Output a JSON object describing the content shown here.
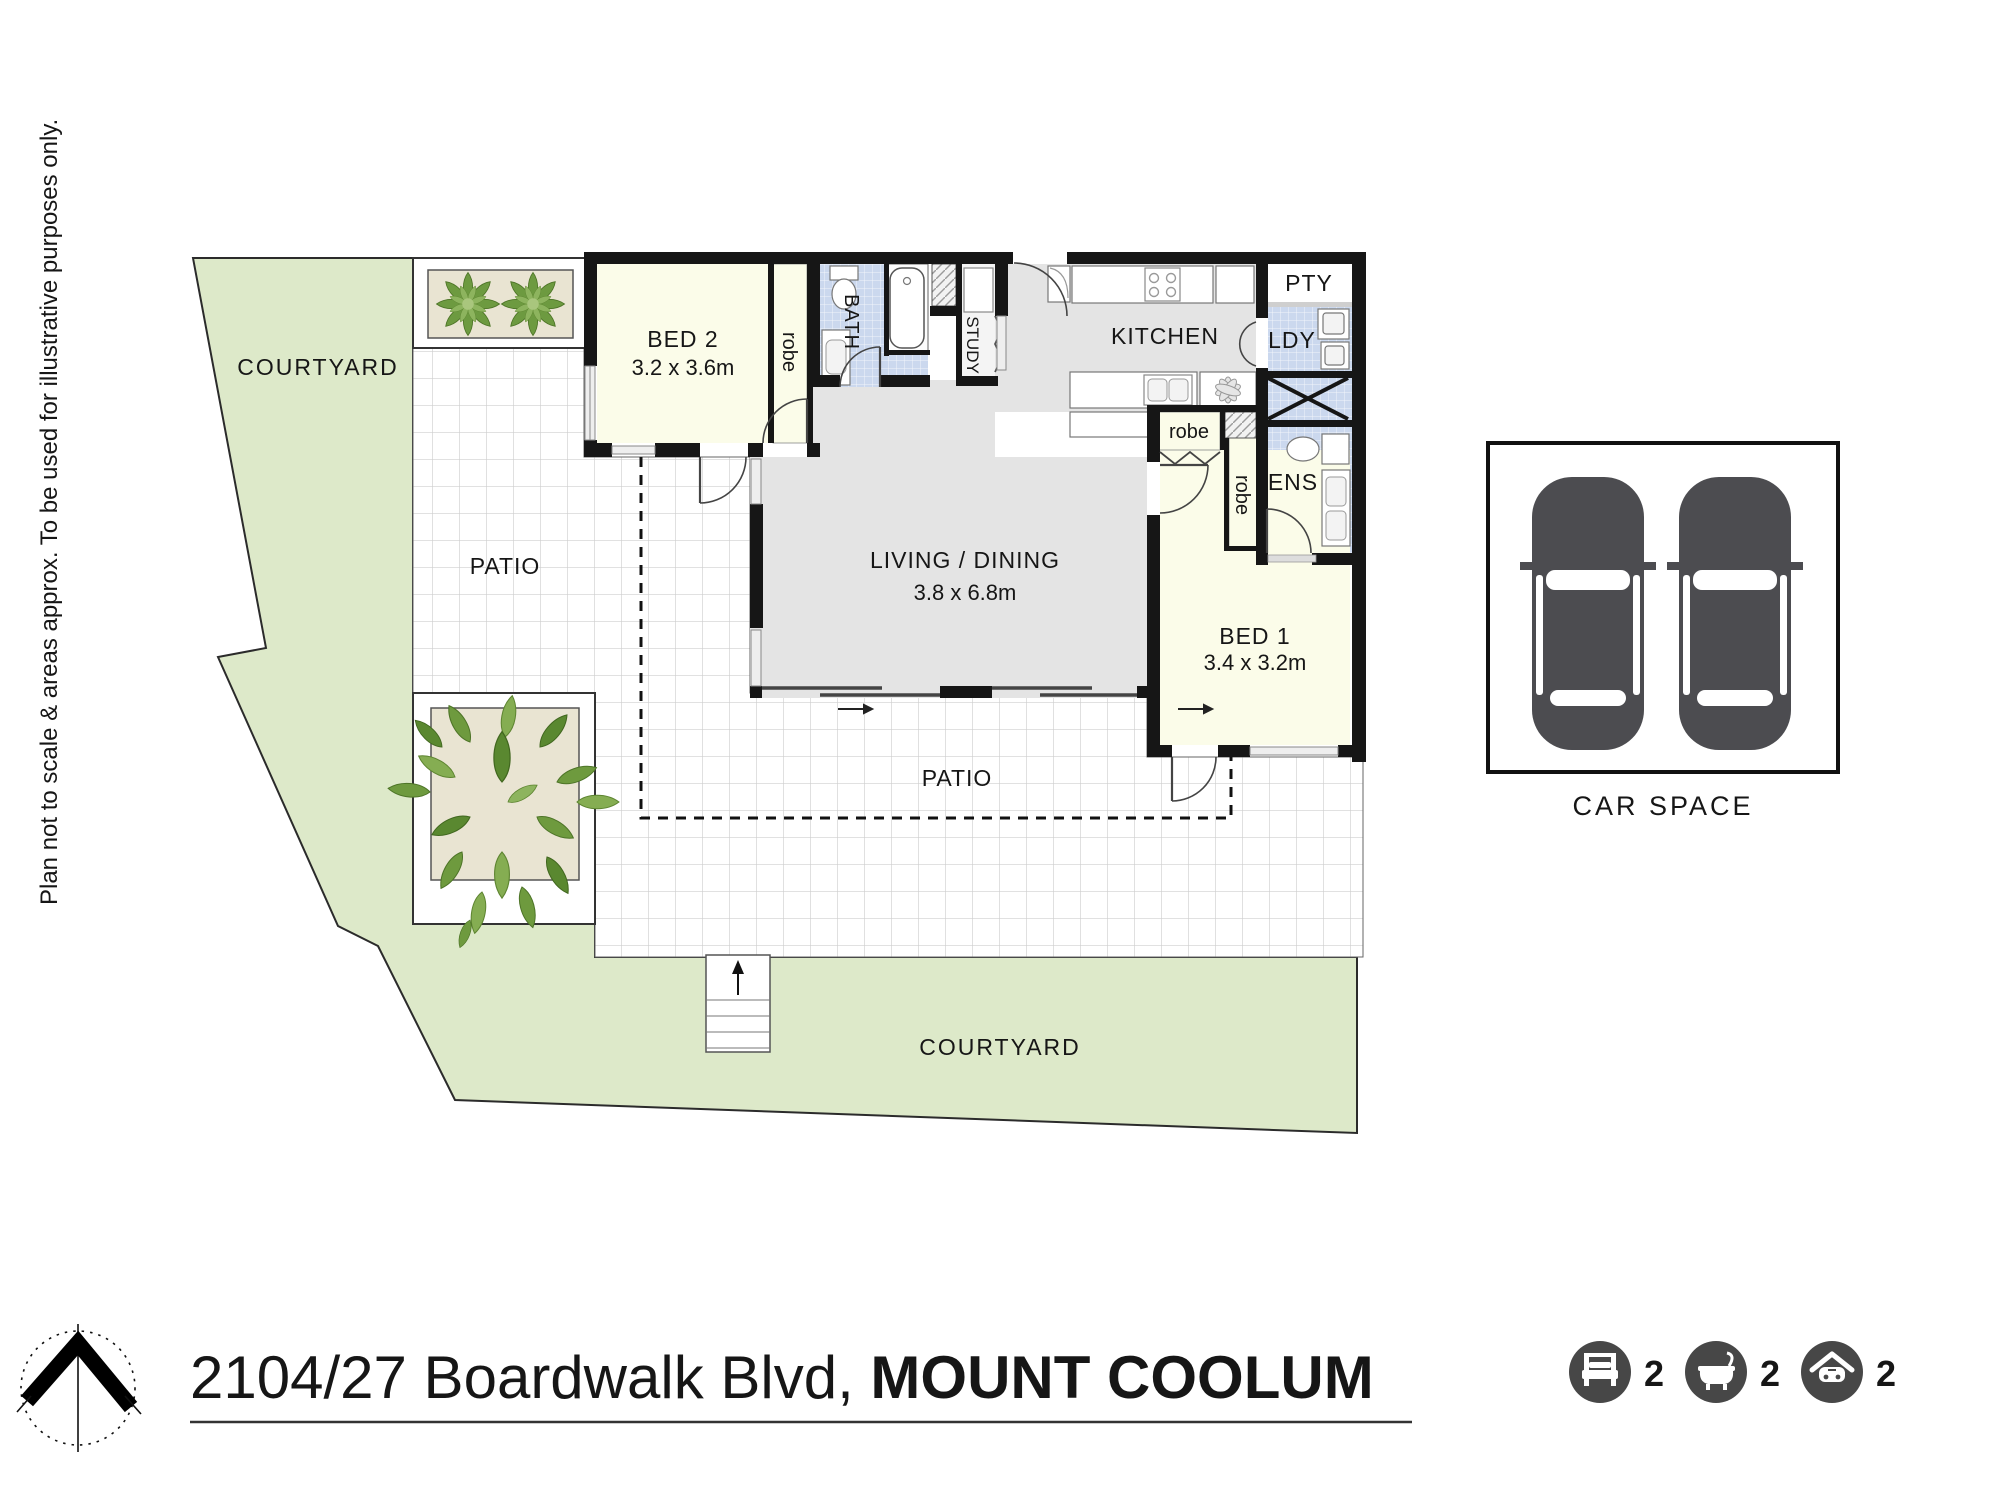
{
  "disclaimer": "Plan not to scale & areas approx. To be used for illustrative purposes only.",
  "title": {
    "address": "2104/27 Boardwalk Blvd, ",
    "suburb": "MOUNT COOLUM"
  },
  "areas": {
    "courtyard_top": "COURTYARD",
    "courtyard_bottom": "COURTYARD",
    "patio_left": "PATIO",
    "patio_bottom": "PATIO"
  },
  "rooms": {
    "bed2_name": "BED 2",
    "bed2_dims": "3.2 x 3.6m",
    "robe_bed2": "robe",
    "bath": "BATH",
    "study": "STUDY",
    "kitchen": "KITCHEN",
    "pty": "PTY",
    "ldy": "LDY",
    "ens": "ENS",
    "robe_bed1_h": "robe",
    "robe_bed1_v": "robe",
    "living_name": "LIVING / DINING",
    "living_dims": "3.8 x 6.8m",
    "bed1_name": "BED 1",
    "bed1_dims": "3.4 x 3.2m"
  },
  "car_space_label": "CAR SPACE",
  "stats": {
    "beds": "2",
    "baths": "2",
    "cars": "2"
  },
  "icons": {
    "bed": "bed-icon",
    "bath": "bath-icon",
    "garage": "garage-icon",
    "compass": "north-compass-icon"
  },
  "colors": {
    "courtyard_green": "#dde9c9",
    "floor_grey": "#e4e4e4",
    "room_cream": "#fbfce9",
    "wet_blue": "#cbd8ee",
    "wall_black": "#161616",
    "planter_beige": "#e9e4d2",
    "leaf_green": "#6f9c42",
    "icon_grey": "#474747"
  }
}
